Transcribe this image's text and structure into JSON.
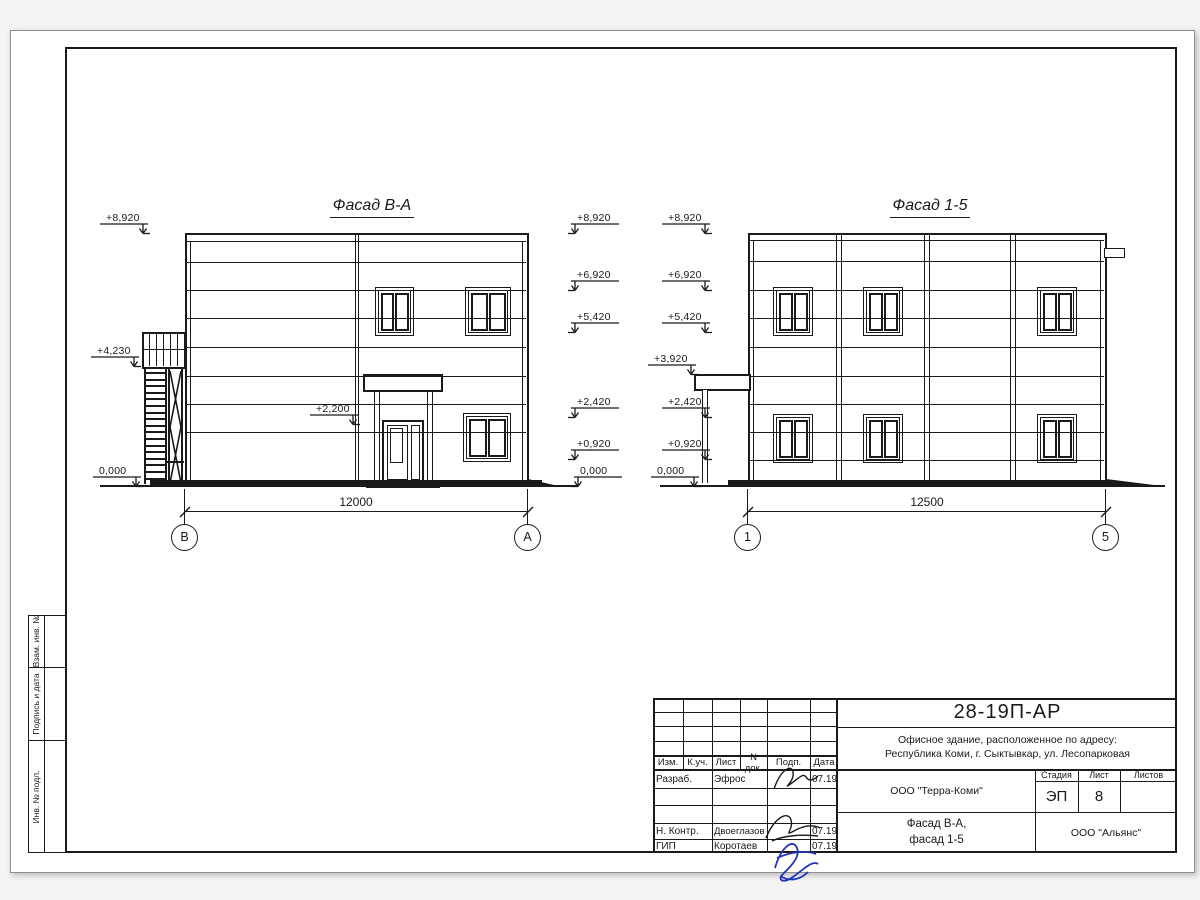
{
  "titleblock": {
    "doc_number": "28-19П-АР",
    "address1": "Офисное здание, расположенное по адресу:",
    "address2": "Республика Коми, г. Сыктывкар, ул. Лесопарковая",
    "org": "ООО \"Терра-Коми\"",
    "org2": "ООО \"Альянс\"",
    "sheet_title1": "Фасад В-А,",
    "sheet_title2": "фасад 1-5",
    "stage_label": "Стадия",
    "stage": "ЭП",
    "sheet_label": "Лист",
    "sheet_no": "8",
    "sheets_label": "Листов",
    "cols": [
      "Изм.",
      "К.уч.",
      "Лист",
      "N док.",
      "Подп.",
      "Дата"
    ],
    "rows": [
      {
        "role": "Разраб.",
        "name": "Эфрос",
        "date": "07.19"
      },
      {
        "role": "Н. Контр.",
        "name": "Двоеглазов",
        "date": "07.19"
      },
      {
        "role": "ГИП",
        "name": "Коротаев",
        "date": "07.19"
      }
    ]
  },
  "margin_labels": [
    "Взам. инв. №",
    "Подпись и дата",
    "Инв. № подл."
  ],
  "drawing": {
    "facade_left": {
      "title": "Фасад В-А",
      "dim": "12000",
      "axis_left": "В",
      "axis_right": "А"
    },
    "facade_right": {
      "title": "Фасад 1-5",
      "dim": "12500",
      "axis_left": "1",
      "axis_right": "5"
    },
    "elevations": [
      {
        "label": "+8,920",
        "x": 106,
        "y": 212,
        "dir": "right"
      },
      {
        "label": "+4,230",
        "x": 97,
        "y": 345,
        "dir": "right"
      },
      {
        "label": "0,000",
        "x": 99,
        "y": 465,
        "dir": "right"
      },
      {
        "label": "+2,200",
        "x": 316,
        "y": 403,
        "dir": "right"
      },
      {
        "label": "+8,920",
        "x": 577,
        "y": 212,
        "dir": "left"
      },
      {
        "label": "+6,920",
        "x": 577,
        "y": 269,
        "dir": "left"
      },
      {
        "label": "+5,420",
        "x": 577,
        "y": 311,
        "dir": "left"
      },
      {
        "label": "+2,420",
        "x": 577,
        "y": 396,
        "dir": "left"
      },
      {
        "label": "+0,920",
        "x": 577,
        "y": 438,
        "dir": "left"
      },
      {
        "label": "0,000",
        "x": 580,
        "y": 465,
        "dir": "left"
      },
      {
        "label": "+8,920",
        "x": 668,
        "y": 212,
        "dir": "right"
      },
      {
        "label": "+6,920",
        "x": 668,
        "y": 269,
        "dir": "right"
      },
      {
        "label": "+5,420",
        "x": 668,
        "y": 311,
        "dir": "right"
      },
      {
        "label": "+3,920",
        "x": 654,
        "y": 353,
        "dir": "right"
      },
      {
        "label": "+2,420",
        "x": 668,
        "y": 396,
        "dir": "right"
      },
      {
        "label": "+0,920",
        "x": 668,
        "y": 438,
        "dir": "right"
      },
      {
        "label": "0,000",
        "x": 657,
        "y": 465,
        "dir": "right"
      }
    ]
  }
}
